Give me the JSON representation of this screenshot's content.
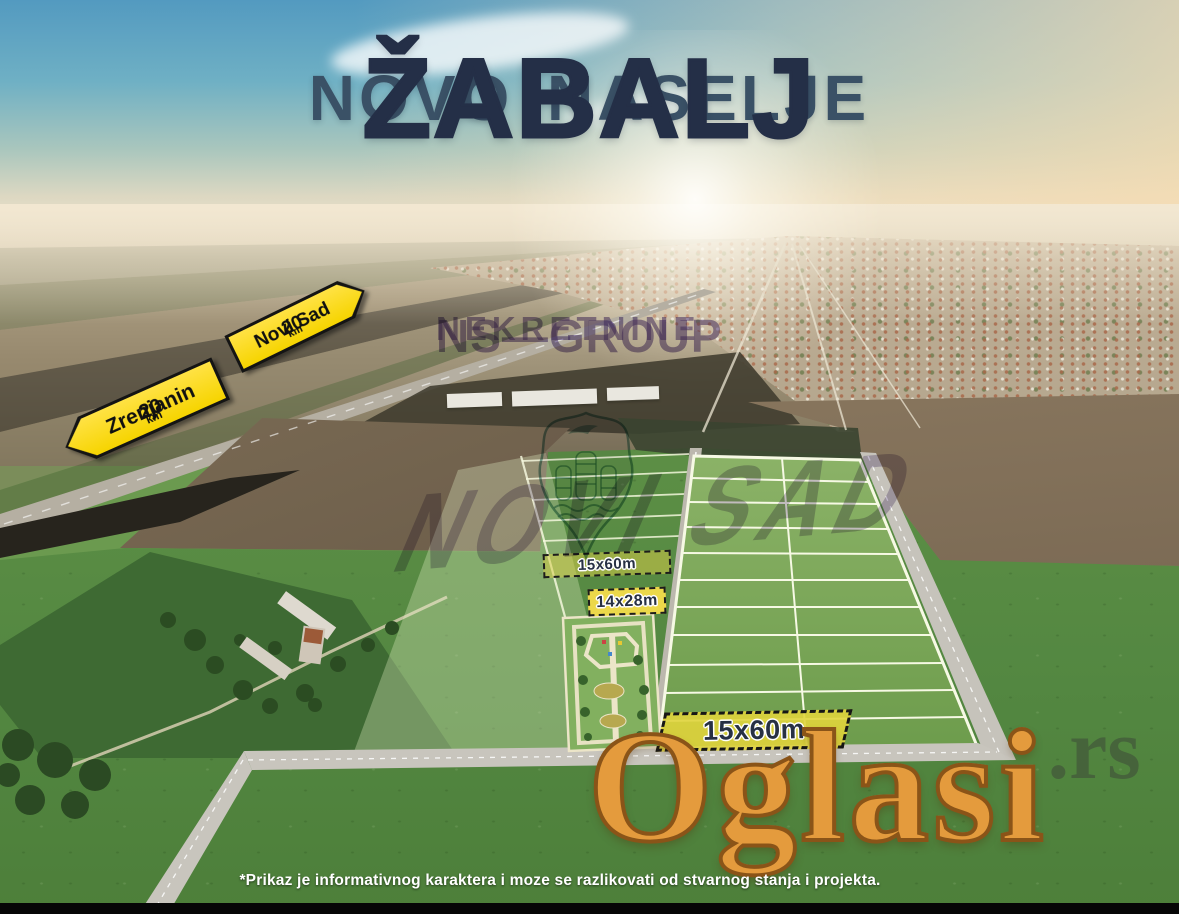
{
  "title": {
    "line_prefix": "NOVO NASELJE",
    "line_emphasis": "ŽABALJ"
  },
  "road_signs": [
    {
      "destination": "Zrenjanin",
      "distance": "20",
      "unit": "km",
      "direction": "left"
    },
    {
      "destination": "Novi Sad",
      "distance": "20",
      "unit": "km",
      "direction": "right"
    }
  ],
  "plots": {
    "strip_label": "15x60m",
    "park_label": "14x28m",
    "featured_label": "15x60m"
  },
  "watermarks": {
    "agency_line1": "NS—GROUP",
    "agency_line2": "NEKRETNINE",
    "agency_city": "NOVI SAD",
    "portal_name": "Oglasi",
    "portal_suffix": ".rs"
  },
  "disclaimer": "*Prikaz je informativnog karaktera i moze se razlikovati od stvarnog stanja i projekta.",
  "colors": {
    "sign-yellow": "#f6d400",
    "label-yellow": "#ecd84a",
    "watermark-purple": "#5a3f8c",
    "watermark-teal": "#1f6b64",
    "portal-orange": "#e49b3d",
    "title-navy": "#242f47",
    "grid-line": "#f6f9e4"
  }
}
